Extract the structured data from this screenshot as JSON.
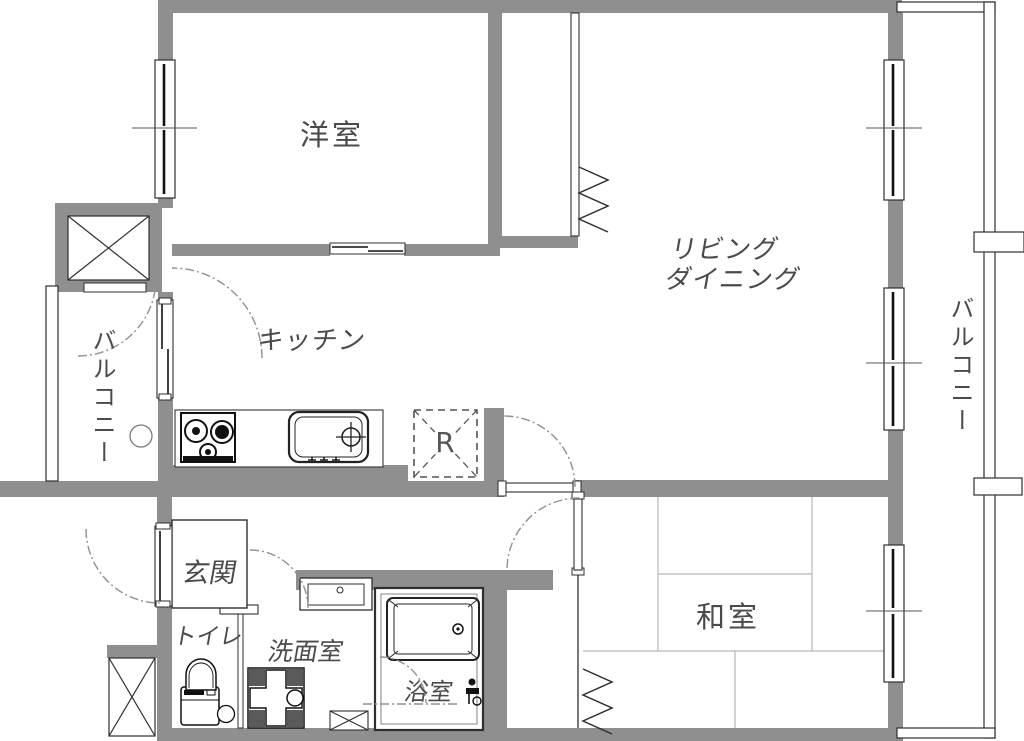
{
  "plan_type": "apartment-floor-plan",
  "colors": {
    "wall": "#8f8f8f",
    "line": "#2f2f2f",
    "text": "#4a4a4a",
    "arc": "#909090",
    "tatami_line": "#b8b8b8",
    "background": "#ffffff"
  },
  "rooms": {
    "western_room": {
      "label": "洋室"
    },
    "living_dining": {
      "lines": [
        "リビング",
        "ダイニング"
      ]
    },
    "kitchen": {
      "label": "キッチン"
    },
    "japanese_room": {
      "label": "和室"
    },
    "entrance": {
      "label": "玄関"
    },
    "toilet": {
      "label": "トイレ"
    },
    "washroom": {
      "label": "洗面室"
    },
    "bathroom": {
      "label": "浴室"
    },
    "balcony_left": {
      "label": "バルコニー"
    },
    "balcony_right": {
      "label": "バルコニー"
    },
    "refrigerator": {
      "label": "R"
    }
  },
  "icons": {
    "stove": "gas-stove-2-burner",
    "sink": "kitchen-sink-with-faucet",
    "bathtub": "bathtub",
    "toilet": "toilet",
    "washing_machine_pan": "washing-machine-pan",
    "shaft": "x-box-shaft",
    "closet_door": "folding-door-zigzag",
    "door_swing": "dash-dot-arc"
  }
}
